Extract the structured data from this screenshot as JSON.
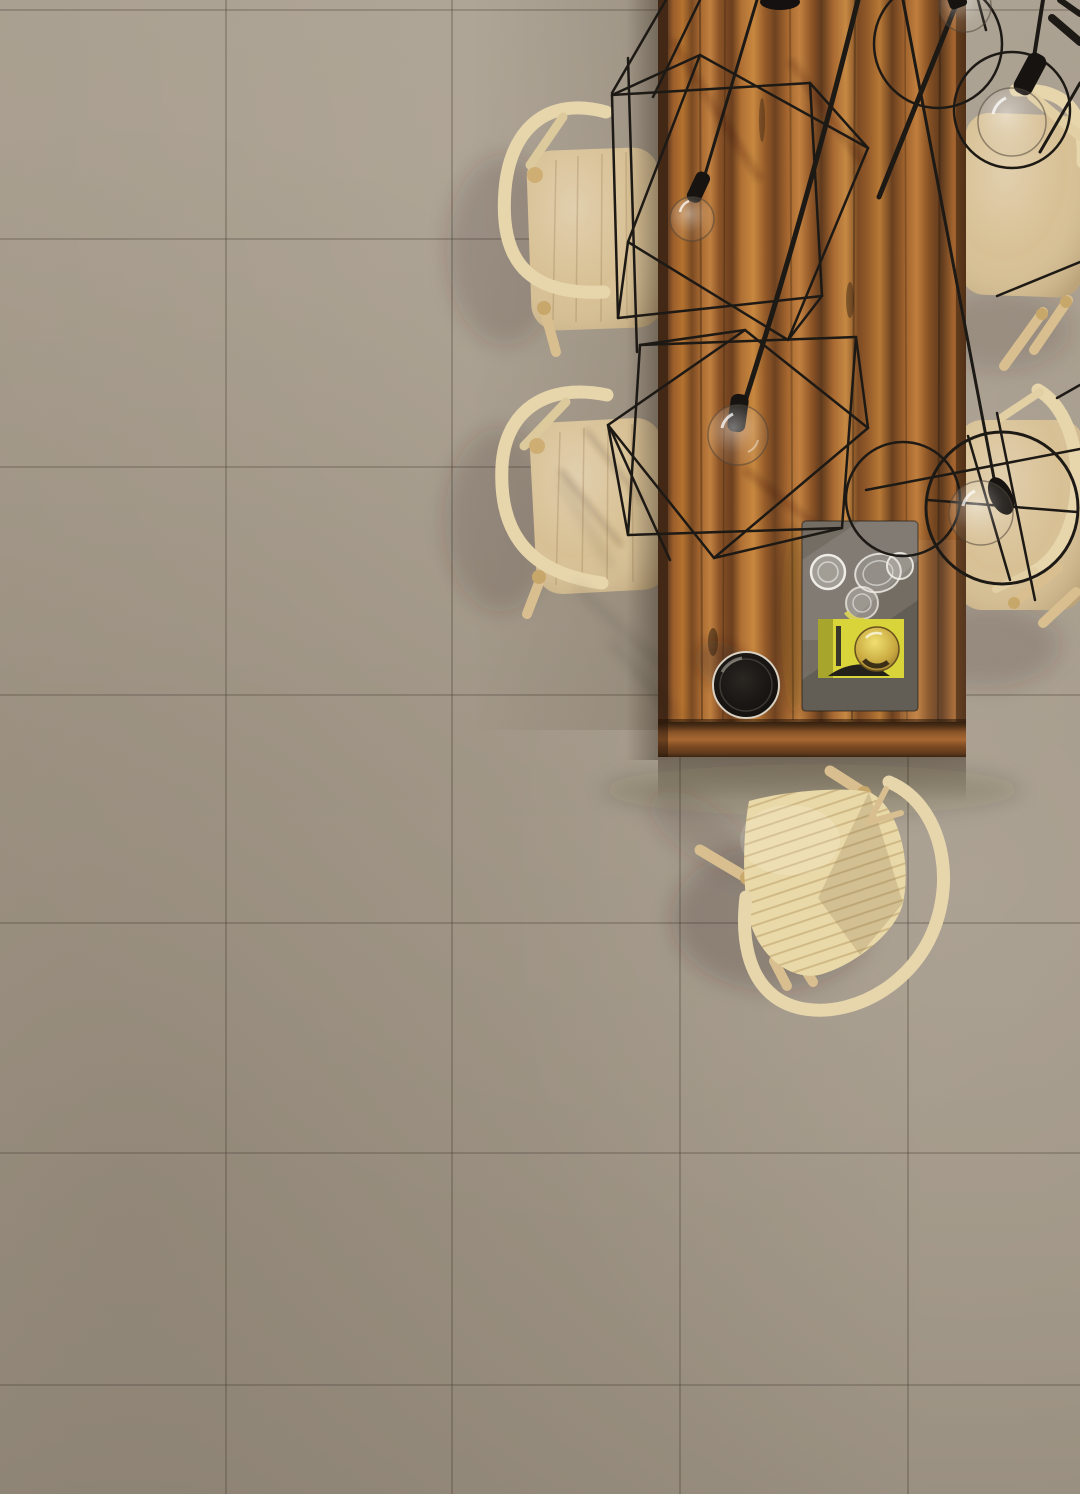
{
  "scene": {
    "description": "Top-down photographic view of a dining area: taupe concrete-look floor tiles, a long striped-wood dining table, five light ash chairs (wishbone style), black wireframe pendant lamps with clear glass bulbs, and a smoked-glass tray with drinking glasses, a yellow booklet, an amber glass sphere and a black bowl on the tabletop.",
    "objects": [
      {
        "label": "tiled-floor"
      },
      {
        "label": "dining-table"
      },
      {
        "label": "chair-top-left"
      },
      {
        "label": "chair-mid-left"
      },
      {
        "label": "chair-top-right"
      },
      {
        "label": "chair-mid-right"
      },
      {
        "label": "chair-bottom"
      },
      {
        "label": "pendant-cube-wireframe-1"
      },
      {
        "label": "pendant-cube-wireframe-2"
      },
      {
        "label": "pendant-sphere-wireframe"
      },
      {
        "label": "light-bulbs",
        "count": 5
      },
      {
        "label": "smoked-glass-tray"
      },
      {
        "label": "drinking-glasses",
        "count": 4
      },
      {
        "label": "yellow-booklet"
      },
      {
        "label": "amber-glass-sphere"
      },
      {
        "label": "black-bowl"
      }
    ]
  },
  "palette": {
    "floor": "#a39888",
    "grout": "rgba(62,53,42,0.32)",
    "wire": "#1d1915",
    "chair_seat": "#d7bf92",
    "chair_frame": "#e7d6ac",
    "chair_leg": "#d9bf90",
    "cord_seat": "#ead9a8",
    "table_light": "#c08040",
    "table_dark": "#5e3a1f",
    "tray": "#736d64",
    "card_yellow": "#d8d43a",
    "bowl_rim": "#d9d1c3",
    "glass_rim": "rgba(245,242,235,0.85)"
  }
}
